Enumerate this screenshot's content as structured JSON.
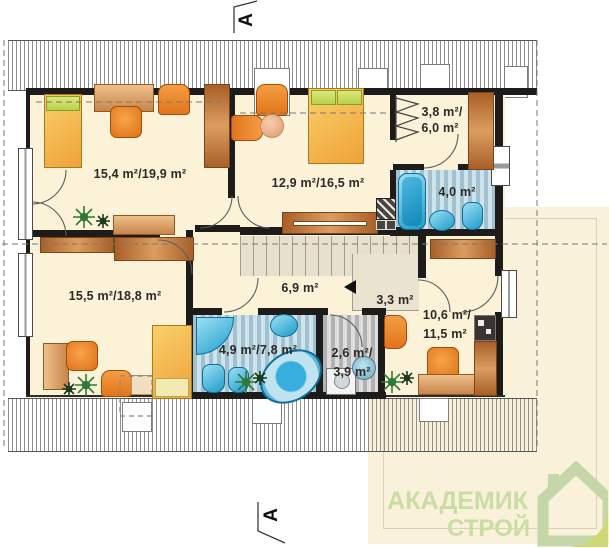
{
  "plan": {
    "title": "attic floor plan",
    "rooms": [
      {
        "id": "bedroom-top-left",
        "area_label": "15,4 m²/19,9 m²"
      },
      {
        "id": "bedroom-top-middle",
        "area_label": "12,9 m²/16,5 m²"
      },
      {
        "id": "wardrobe-closet",
        "area_label_line1": "3,8 m²/",
        "area_label_line2": "6,0 m²"
      },
      {
        "id": "bathroom-small",
        "area_label": "4,0 m²"
      },
      {
        "id": "bedroom-bottom-left",
        "area_label": "15,5 m²/18,8 m²"
      },
      {
        "id": "hall",
        "area_label": "6,9 m²"
      },
      {
        "id": "stair-landing",
        "area_label": "3,3 m²"
      },
      {
        "id": "bedroom-bottom-right",
        "area_label_line1": "10,6 m²/",
        "area_label_line2": "11,5 m²"
      },
      {
        "id": "bathroom-large",
        "area_label": "4,9 m²/7,8 m²"
      },
      {
        "id": "laundry",
        "area_label_line1": "2,6 m²/",
        "area_label_line2": "3,9 m²"
      }
    ],
    "section_markers": {
      "top": "A",
      "bottom": "A"
    }
  },
  "watermark": {
    "brand_line1": "АКАДЕМИК",
    "brand_line2": "СТРОЙ",
    "icon": "house-icon",
    "text_color": "#c9dda4",
    "icon_green": "#c5d7a8",
    "icon_leaf_green": "#cdd976",
    "background": "#f9f1d9"
  },
  "colors": {
    "room_floor": "#fbf2d8",
    "wall": "#1d1c1a",
    "bath_fixture_blue": "#1f9ccc",
    "furniture_orange": "#e0751a",
    "bed_yellow": "#efa238"
  }
}
